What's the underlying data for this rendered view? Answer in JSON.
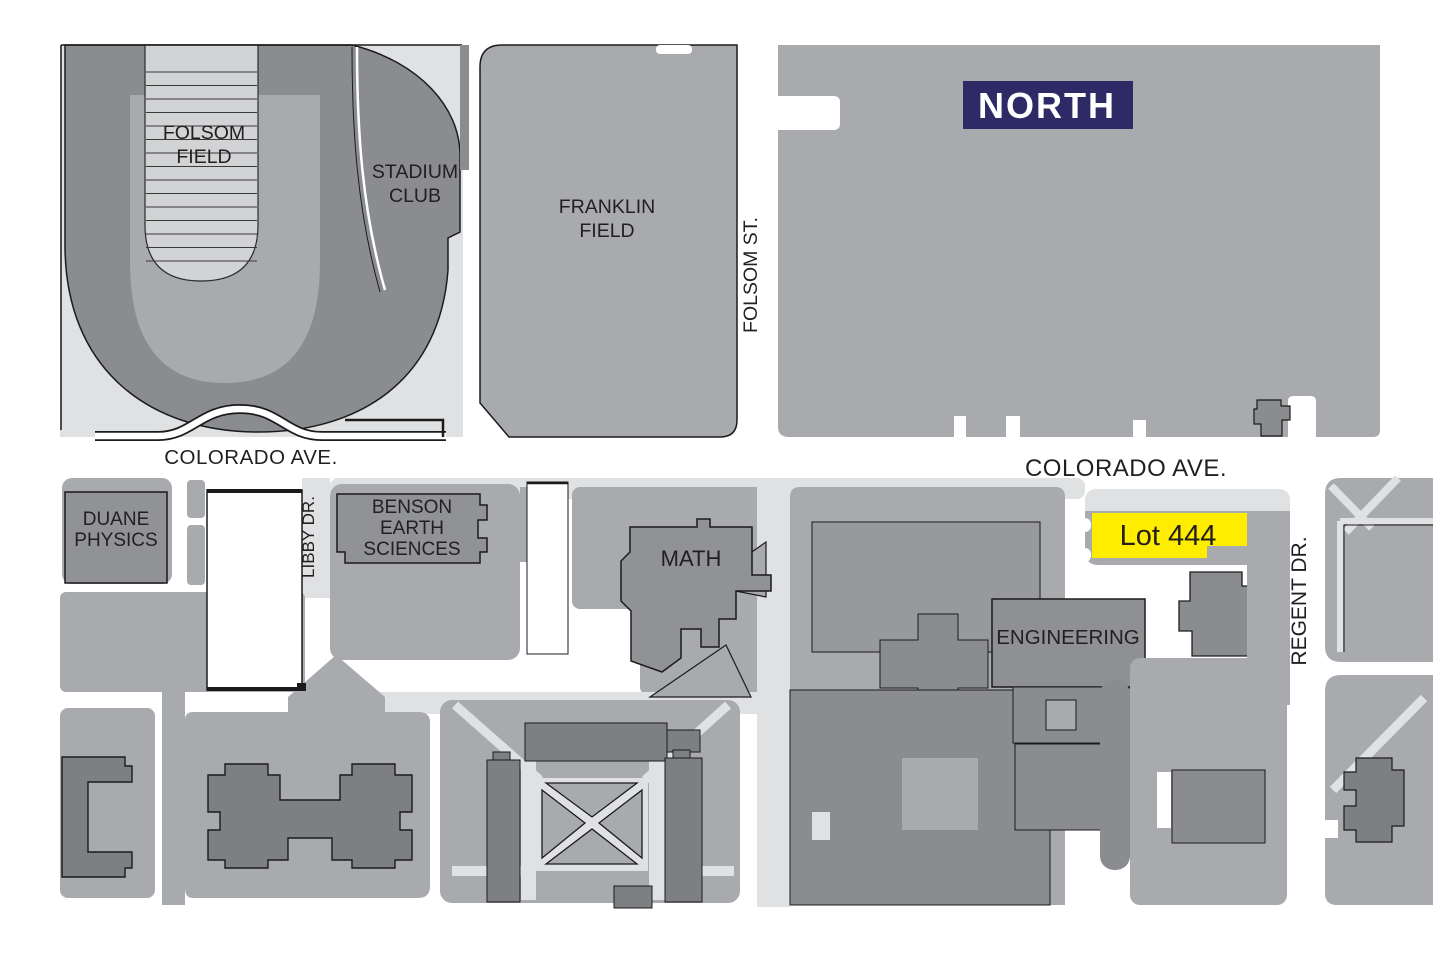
{
  "colors": {
    "page_bg": "#ffffff",
    "street_white": "#ffffff",
    "path_light": "#e0e1e3",
    "field_light": "#d2d3d5",
    "block_medium": "#a8aaad",
    "building_gray": "#909296",
    "building_dark": "#7d7f83",
    "stadium_gray": "#8a8c8f",
    "outline": "#1b1b1b",
    "north_badge_bg": "#2e2a66",
    "north_badge_fg": "#ffffff",
    "lot_highlight": "#ffed00",
    "label_text": "#231f20"
  },
  "compass": {
    "label": "NORTH"
  },
  "streets": {
    "colorado_ave_west": "COLORADO AVE.",
    "colorado_ave_east": "COLORADO AVE.",
    "folsom_st": "FOLSOM ST.",
    "libby_dr": "LIBBY DR.",
    "regent_dr": "REGENT DR."
  },
  "places": {
    "folsom_field": [
      "FOLSOM",
      "FIELD"
    ],
    "stadium_club": [
      "STADIUM",
      "CLUB"
    ],
    "franklin_field": [
      "FRANKLIN",
      "FIELD"
    ],
    "duane_physics": [
      "DUANE",
      "PHYSICS"
    ],
    "benson_earth_sciences": [
      "BENSON",
      "EARTH",
      "SCIENCES"
    ],
    "math": "MATH",
    "engineering": "ENGINEERING",
    "lot_444": "Lot 444"
  }
}
